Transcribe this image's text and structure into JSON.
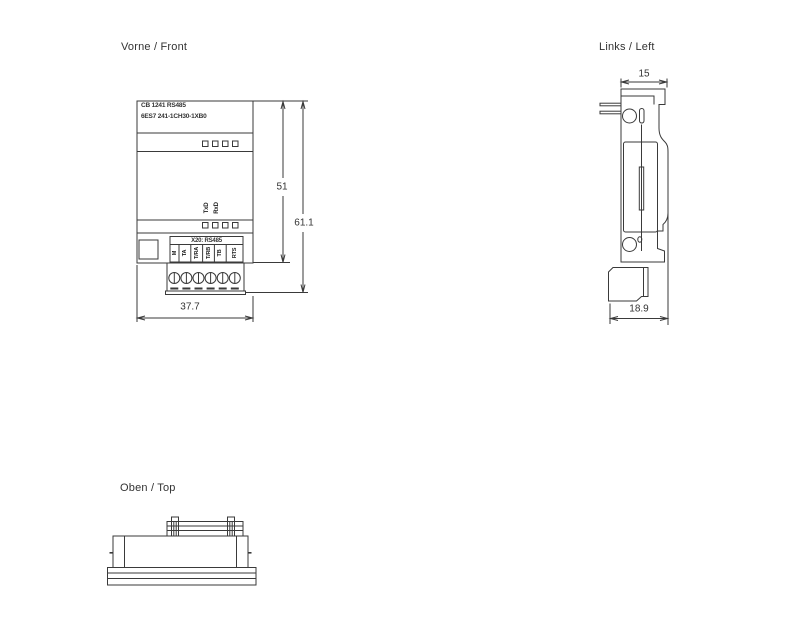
{
  "drawing": {
    "views": {
      "front": {
        "title": "Vorne / Front",
        "module": {
          "name_line1": "CB 1241 RS485",
          "name_line2": "6ES7 241-1CH30-1XB0",
          "signal_labels": [
            "TxD",
            "RxD"
          ],
          "port_label": "X20: RS485",
          "terminal_labels": [
            "M",
            "TA",
            "T/RA",
            "T/RB",
            "TB",
            "RTS"
          ]
        },
        "dimensions": {
          "body_height": "51",
          "total_height": "61.1",
          "width": "37.7"
        }
      },
      "left": {
        "title": "Links / Left",
        "dimensions": {
          "top_width": "15",
          "bottom_depth": "18.9"
        }
      },
      "top": {
        "title": "Oben / Top"
      }
    },
    "colors": {
      "line": "#3a3a3a",
      "text": "#333333",
      "background": "#ffffff"
    }
  }
}
